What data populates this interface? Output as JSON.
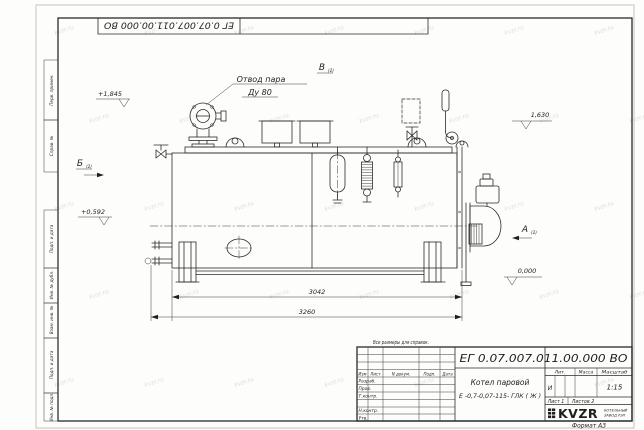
{
  "watermark": "kvzr.ru",
  "corner_stamp": {
    "code": "ЕГ 0.07.007.011.00.000  ВО"
  },
  "margin_stamps": [
    "Перв. примен.",
    "Справ. №",
    "Подп. и дата",
    "Инв. № дубл.",
    "Взам. инв. №",
    "Подп. и дата",
    "Инв. № подл."
  ],
  "annotations": {
    "steam_outlet_line1": "Отвод пара",
    "steam_outlet_line2": "Ду 80",
    "note": "Все размеры для справок.",
    "view_a": "А",
    "view_b": "Б",
    "view_v": "В",
    "view_sheet_ref": "(2)",
    "elev_top_left": "+1,845",
    "elev_top_right": "1,630",
    "elev_mid_left": "+0,592",
    "elev_zero": "0,000"
  },
  "dimensions": {
    "shell_length": "3042",
    "overall_length": "3260"
  },
  "title_block": {
    "code": "ЕГ 0.07.007.011.00.000  ВО",
    "product_line1": "Котел паровой",
    "product_line2": "Е -0,7-0,07-115- ГЛК ( Ж )",
    "litera_header": "Лит.",
    "mass_header": "Масса",
    "scale_header": "Масштаб",
    "litera": "И",
    "scale": "1:15",
    "sheet": "Лист 1",
    "sheets": "Листов 2",
    "col_izm": "Изм",
    "col_list": "Лист",
    "col_ndokum": "N докум.",
    "col_podp": "Подп.",
    "col_data": "Дата",
    "row_labels": [
      "Разраб.",
      "Пров.",
      "Т.контр.",
      "Н.контр.",
      "Утв."
    ],
    "logo": "KVZR",
    "company_line1": "КОТЕЛЬНЫЙ",
    "company_line2": "ЗАВОД РЭП",
    "format": "Формат А3"
  }
}
